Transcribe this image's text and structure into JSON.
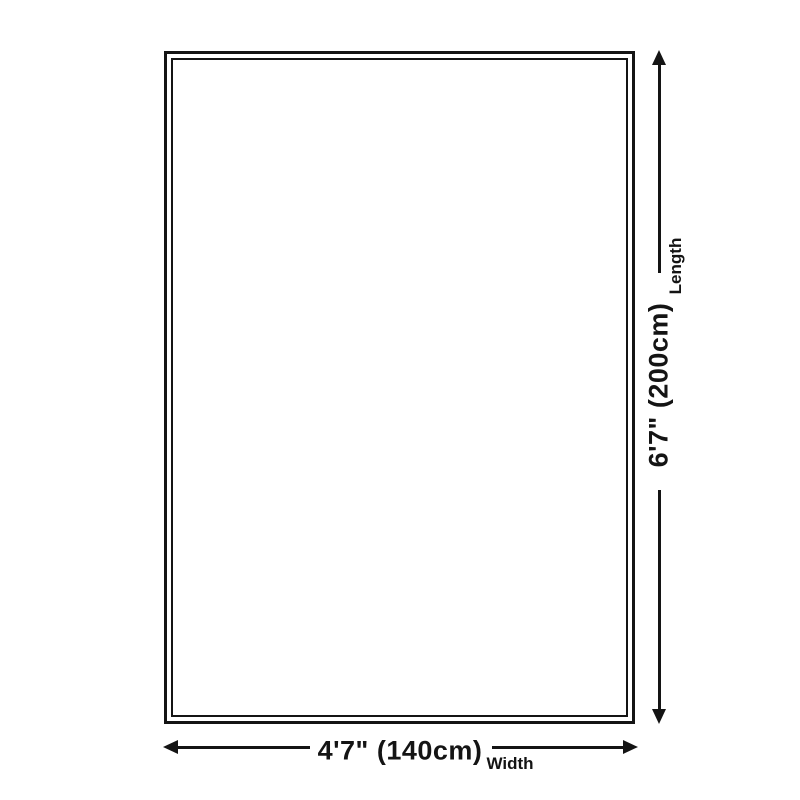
{
  "diagram": {
    "background_color": "#ffffff",
    "line_color": "#141414",
    "shape": "rectangle-double-border",
    "length": {
      "value": "6'7\" (200cm)",
      "label": "Length"
    },
    "width": {
      "value": "4'7\" (140cm)",
      "label": "Width"
    }
  }
}
